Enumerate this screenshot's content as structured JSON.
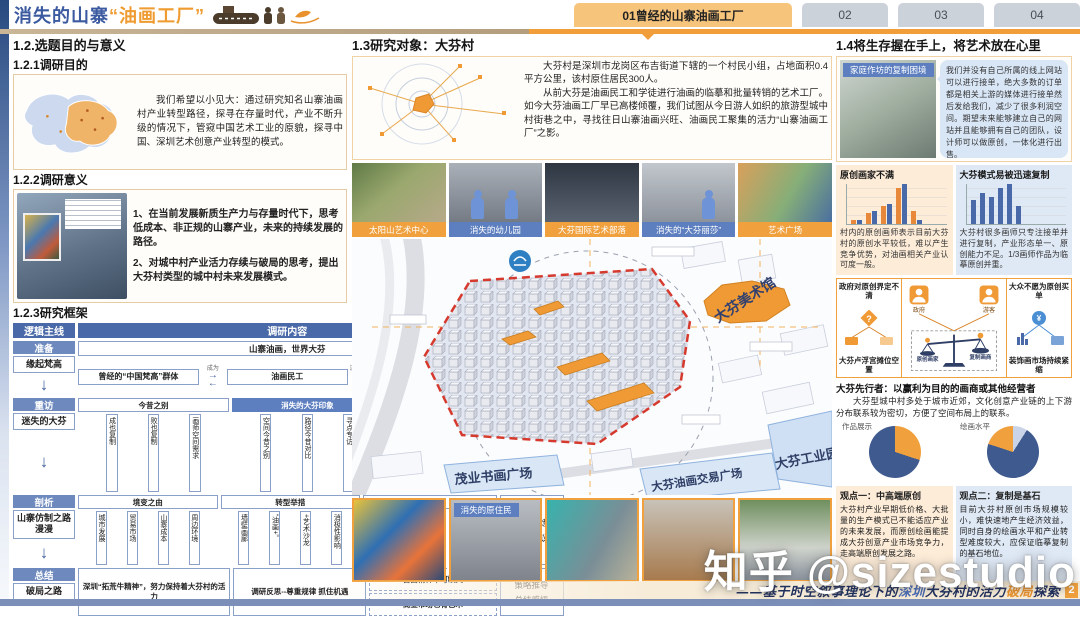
{
  "header": {
    "title_blue": "消失的山寨",
    "title_orange": "“油画工厂”",
    "tabs": [
      {
        "label": "01曾经的山寨油画工厂",
        "active": true
      },
      {
        "label": "02",
        "active": false
      },
      {
        "label": "03",
        "active": false
      },
      {
        "label": "04",
        "active": false
      }
    ]
  },
  "left": {
    "s12_title": "1.2.选题目的与意义",
    "s121_title": "1.2.1调研目的",
    "purpose_text": "我们希望以小见大：通过研究知名山寨油画村产业转型路径，探寻在存量时代，产业不断升级的情况下，管窥中国艺术工业的原貌，探寻中国、深圳艺术创意产业转型的模式。",
    "s122_title": "1.2.2调研意义",
    "significance_1": "1、在当前发展新质生产力与存量时代下，思考低成本、非正规的山寨产业，未来的持续发展的路径。",
    "significance_2": "2、对城中村产业活力存续与破局的思考，提出大芬村类型的城中村未来发展模式。",
    "s123_title": "1.2.3研究框架",
    "framework": {
      "headers": [
        "逻辑主线",
        "调研内容",
        "研究方法"
      ],
      "stages": [
        {
          "chip": "准备",
          "label": "缘起梵高"
        },
        {
          "chip": "重访",
          "label": "迷失的大芬"
        },
        {
          "chip": "剖析",
          "label": "山寨仿制之路漫漫"
        },
        {
          "chip": "总结",
          "label": "破局之路"
        }
      ],
      "row1": {
        "banner": "山寨油画，世界大芬",
        "flow_left": "曾经的“中国梵高”群体",
        "arrow1_label": "成为",
        "flow_mid": "油画民工",
        "arrow2_label": "流水线量产",
        "flow_right": "生产大批量仿制画"
      },
      "row2": {
        "groups": [
          {
            "head": "今昔之别",
            "chips": [
              "成也复制",
              "败也复制",
              "画师空间需求"
            ]
          },
          {
            "head": "消失的大芬印象",
            "chips": [
              "空间今昔之别",
              "路径今昔对比",
              "寻点专访"
            ]
          },
          {
            "head": "消失的油画民工",
            "chips": [
              "消失的油画“流水线”",
              "消失的画工"
            ]
          }
        ]
      },
      "row3": {
        "groups": [
          {
            "head": "境变之由",
            "chips": [
              "城市发展",
              "贸易市场",
              "山寨成本",
              "周边环境"
            ]
          },
          {
            "head": "转型举措",
            "chips": [
              "墙壁画廊",
              "“油画+”",
              "+艺术沙龙",
              "消极性影响"
            ]
          },
          {
            "head": "提升建议",
            "chips": [
              "空间规划",
              "空间改造建议",
              "管理运营建议"
            ]
          }
        ]
      },
      "row4": {
        "box1": "深圳“拓荒牛精神”，努力保持着大芬村的活力",
        "box2": "调研反思--尊重规律 抓住机遇",
        "box3a": "自由精神不可缺失",
        "box3b": "商业市场也有艺术"
      },
      "methods": [
        [
          "文献研读",
          "实地走访"
        ],
        [
          "时空重“演”",
          "人物再“构”",
          "半结构访谈",
          "实地调研"
        ],
        [
          "归纳提炼",
          "提出建议"
        ],
        [
          "策略推导",
          "总结感悟"
        ]
      ]
    }
  },
  "center": {
    "s13_title": "1.3研究对象：大芬村",
    "intro_p1": "大芬村是深圳市龙岗区布吉街道下辖的一个村民小组，占地面积0.4平方公里，该村原住居民300人。",
    "intro_p2": "从前大芬是油画民工和学徒进行油画的临摹和批量转销的艺术工厂。如今大芬油画工厂早已高楼倾覆，我们试图从今日游人如织的旅游型城中村街巷之中，寻找往日山寨油画兴旺、油画民工聚集的活力“山寨油画工厂”之影。",
    "photo_labels": [
      {
        "text": "太阳山艺术中心",
        "color": "orange"
      },
      {
        "text": "消失的幼儿园",
        "color": "blue"
      },
      {
        "text": "大芬国际艺术部落",
        "color": "orange"
      },
      {
        "text": "消失的“大芬丽莎”",
        "color": "blue"
      },
      {
        "text": "艺术广场",
        "color": "orange"
      }
    ],
    "map_labels": {
      "museum": "大芬美术馆",
      "maoye": "茂业书画广场",
      "trade_plaza": "大芬油画交易广场",
      "industry_park": "大芬工业园",
      "natives": "消失的原住民"
    }
  },
  "right": {
    "s14_title": "1.4将生存握在手上，将艺术放在心里",
    "photo_label": "家庭作坊的复制困境",
    "quote": "我们并没有自己所属的线上网站可以进行接单，绝大多数的订单都是相关上游的媒体进行接单然后发给我们，减少了很多利润空间。期望未来能够建立自己的网站并且能够拥有自己的团队，设计师可以做原创，一体化进行出售。",
    "chart1_title": "原创画家不满",
    "chart1_text": "村内的原创画师表示目前大芬村的原创水平较低，难以产生竞争优势，对油画相关产业认可度一般。",
    "chart2_title": "大芬模式易被迅速复制",
    "chart2_text": "大芬村很多画师只专注接单并进行复制，产业形态单一、原创能力不足。1/3画师作品为临摹原创并重。",
    "dilemma": {
      "left_title": "政府对原创界定不清",
      "left_caption": "大芬卢浮宫摊位空置",
      "actor1": "政府",
      "actor2": "游客",
      "scale_left": "原创画家",
      "scale_right": "复制画商",
      "right_title": "大众不愿为原创买单",
      "right_caption": "装饰画市场持续紧缩"
    },
    "pioneer_title": "大芬先行者：以赢利为目的的画商或其他经营者",
    "pioneer_text": "大芬型城中村多处于城市近郊，文化创意产业链的上下游分布联系较为密切，方便了空间布局上的联系。",
    "pie1_label": "作品展示",
    "pie2_label": "绘画水平",
    "view1_title": "观点一：中高端原创",
    "view1_text": "大芬村产业早期低价格、大批量的生产模式已不能适应产业的未来发展，而原创绘画能提成大芬创意产业市场竞争力，走高端原创发展之路。",
    "view2_title": "观点二：复制是基石",
    "view2_text": "目前大芬村原创市场规模较小，难快速地产生经济效益，同时自身的绘画水平和产业转型难度较大，应保证临摹复制的基石地位。"
  },
  "footer": {
    "caption_prefix": "——基于时空叙事理论下的",
    "caption_city": "深圳",
    "caption_mid": "大芬村的活力",
    "caption_highlight": "破局",
    "caption_suffix": "探索",
    "page": "2"
  },
  "watermark": "知乎 @sizestudio",
  "glyphs": {
    "down_arrow": "↓",
    "right_arrow": "→",
    "left_arrow": "←",
    "question": "?",
    "yuan": "¥"
  },
  "colors": {
    "accent_orange": "#f09a36",
    "brand_blue": "#4a69a8",
    "boundary_red": "#d63a2e",
    "footer_blue": "#7b8fb9"
  },
  "chart_data": [
    {
      "id": "dissatisfaction",
      "type": "bar",
      "title": "原创画家不满",
      "categories": [
        "1",
        "2",
        "3",
        "4",
        "5"
      ],
      "series": [
        {
          "name": "橙色系列",
          "color": "#e8883a",
          "values": [
            1,
            2.5,
            4,
            8,
            3
          ]
        },
        {
          "name": "蓝色系列",
          "color": "#4a69a8",
          "values": [
            0.8,
            3,
            4.5,
            9,
            0.9
          ]
        }
      ],
      "xlabel": "",
      "ylabel": "",
      "legend": false,
      "grid": true
    },
    {
      "id": "copyable",
      "type": "bar",
      "title": "大芬模式易被迅速复制",
      "categories": [
        "1",
        "2",
        "3",
        "4",
        "5",
        "6"
      ],
      "series": [
        {
          "name": "蓝色系列",
          "color": "#4a69a8",
          "values": [
            5.5,
            7,
            6,
            8,
            9,
            4
          ]
        }
      ],
      "xlabel": "",
      "ylabel": "",
      "legend": false,
      "grid": true
    },
    {
      "id": "works-display",
      "type": "pie",
      "title": "作品展示",
      "slices": [
        {
          "name": "原创展示",
          "value": 30,
          "color": "#f0a03c"
        },
        {
          "name": "临摹复制展示",
          "value": 70,
          "color": "#3e5a8e"
        }
      ]
    },
    {
      "id": "painting-level",
      "type": "pie",
      "title": "绘画水平",
      "slices": [
        {
          "name": "其他",
          "value": 9,
          "color": "#c9d4e8"
        },
        {
          "name": "临摹为主",
          "value": 71,
          "color": "#3e5a8e"
        },
        {
          "name": "原创",
          "value": 20,
          "color": "#f0a03c"
        }
      ]
    }
  ]
}
